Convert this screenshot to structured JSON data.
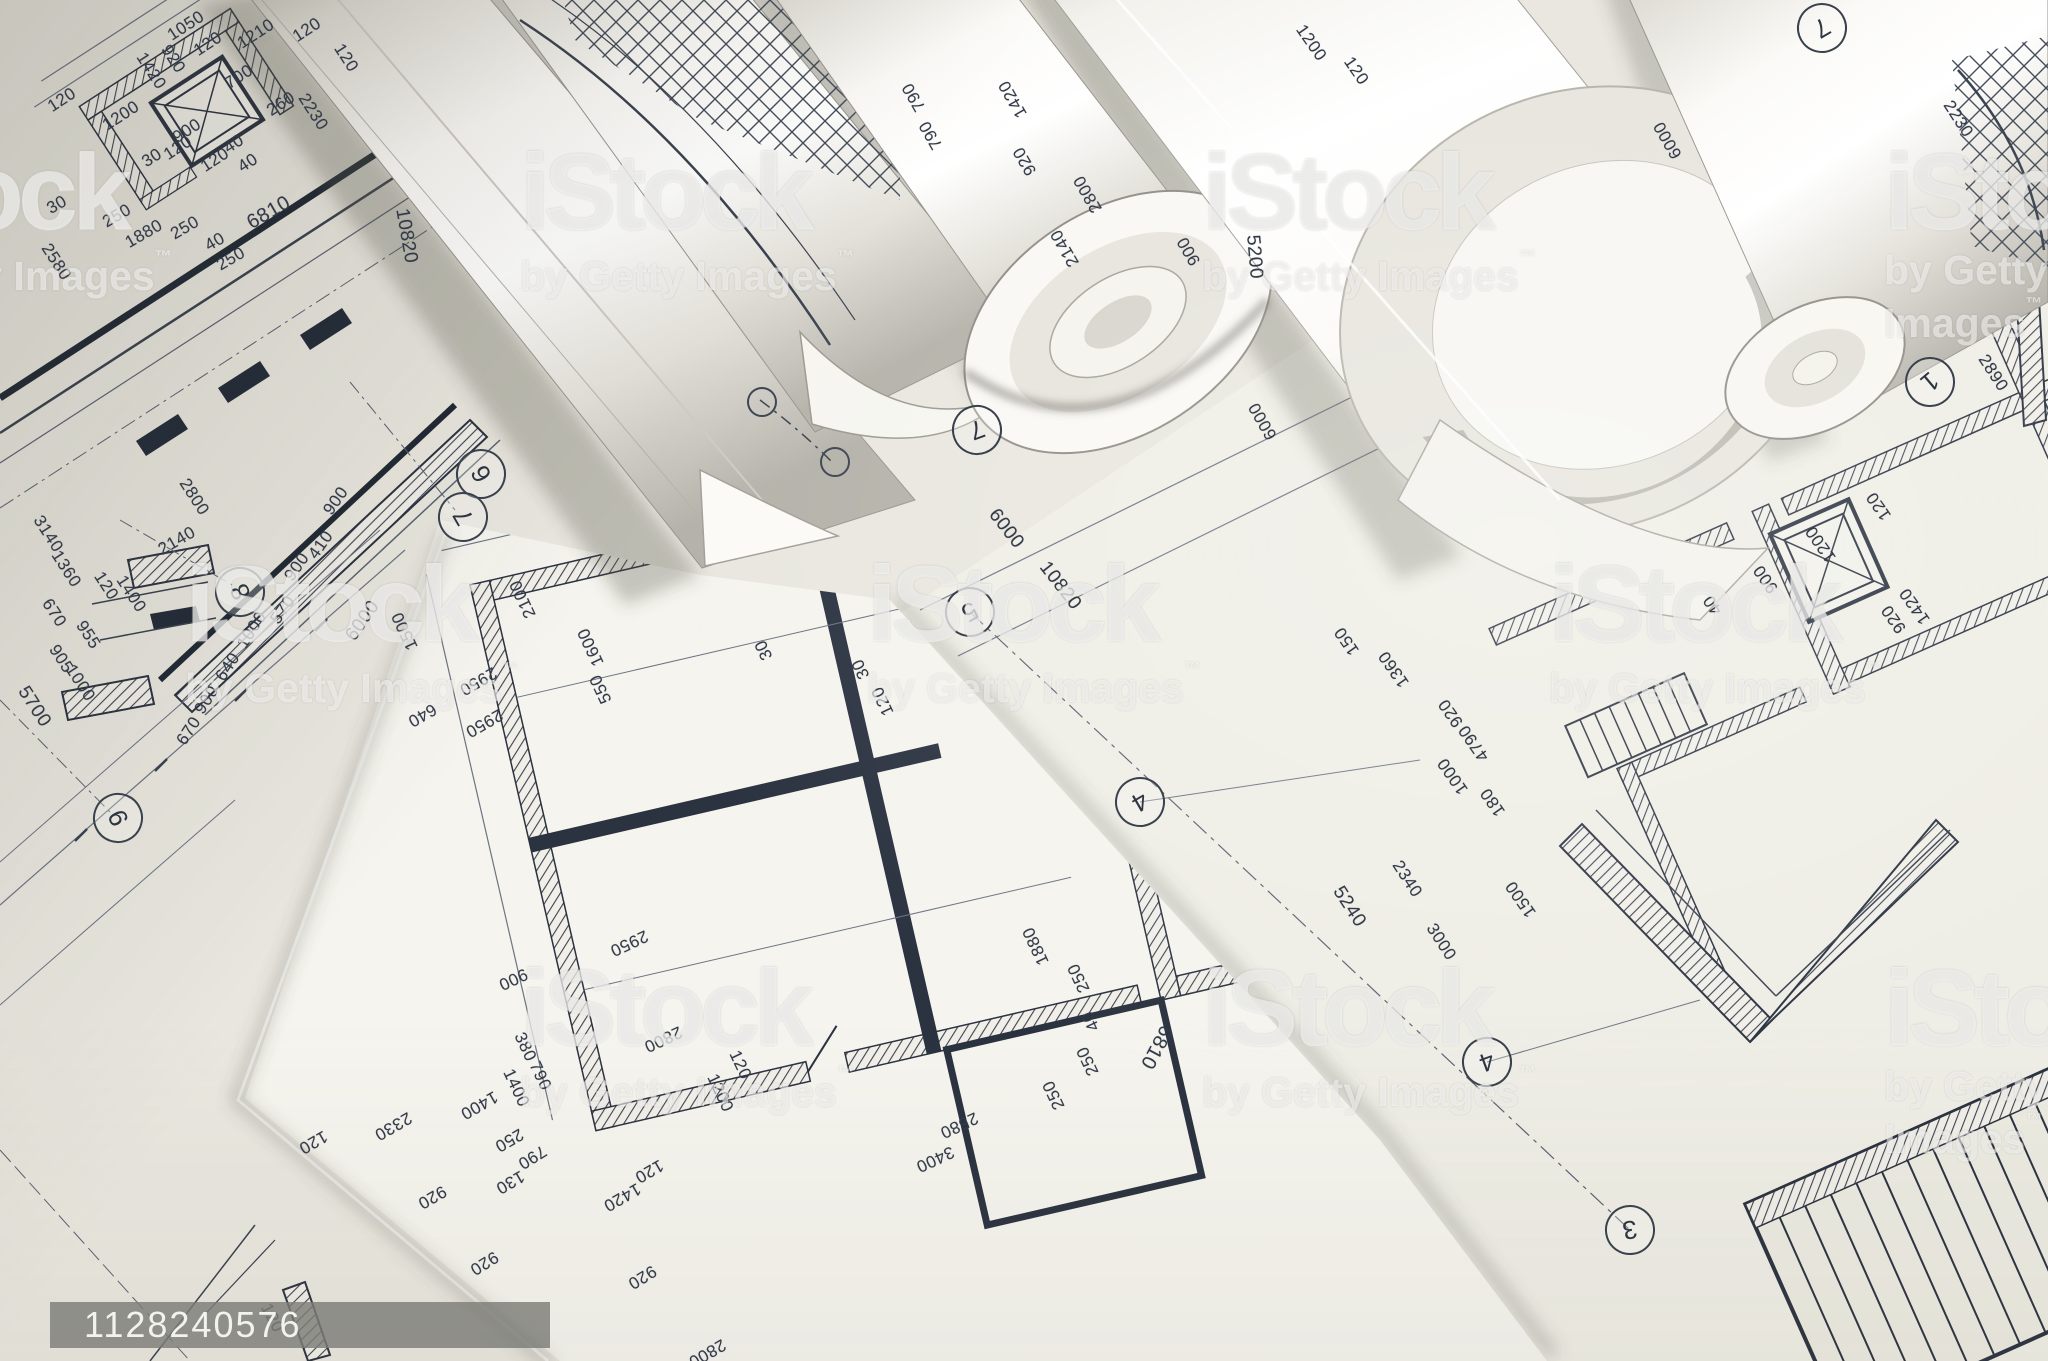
{
  "photo": {
    "subject": "rolled architectural blueprint plans",
    "palette": {
      "paper_bright": "#f5f4ee",
      "paper_mid": "#eceae2",
      "paper_dim": "#e3e1d8",
      "line_dark": "#2b3240",
      "line_mid": "#5a6272",
      "shadow": "#6b695f"
    }
  },
  "watermark": {
    "brand": "iStock",
    "byline": "by Getty Images",
    "tm": "™",
    "color": "#ffffff",
    "positions": [
      {
        "x": -162,
        "y": 148
      },
      {
        "x": 520,
        "y": 148
      },
      {
        "x": 1202,
        "y": 148
      },
      {
        "x": 1884,
        "y": 148
      },
      {
        "x": 185,
        "y": 560
      },
      {
        "x": 867,
        "y": 560
      },
      {
        "x": 1549,
        "y": 560
      },
      {
        "x": 520,
        "y": 964
      },
      {
        "x": 1202,
        "y": 964
      },
      {
        "x": 1884,
        "y": 964
      }
    ]
  },
  "id_badge": {
    "text": "1128240576",
    "bg": "#7d7d77",
    "fg": "#f2f2ee"
  },
  "labels_format": "[text, x, y, rotation_deg, optional_font_px]",
  "labels": [
    [
      "1050",
      186,
      26,
      -33
    ],
    [
      "1210",
      256,
      34,
      -33
    ],
    [
      "120",
      307,
      30,
      -33
    ],
    [
      "120",
      208,
      44,
      -33
    ],
    [
      "700",
      239,
      77,
      -33
    ],
    [
      "260",
      281,
      104,
      -33
    ],
    [
      "1200",
      121,
      116,
      -33
    ],
    [
      "120",
      62,
      100,
      -33
    ],
    [
      "1420",
      151,
      71,
      57
    ],
    [
      "920",
      173,
      59,
      57
    ],
    [
      "2230",
      313,
      112,
      57
    ],
    [
      "120",
      346,
      58,
      57
    ],
    [
      "900",
      187,
      131,
      -33
    ],
    [
      "120",
      178,
      148,
      -33
    ],
    [
      "30",
      152,
      158,
      -33
    ],
    [
      "120",
      215,
      160,
      -33
    ],
    [
      "40",
      234,
      144,
      -33
    ],
    [
      "40",
      248,
      163,
      -33
    ],
    [
      "30",
      57,
      205,
      -30
    ],
    [
      "250",
      117,
      216,
      -30
    ],
    [
      "1880",
      144,
      234,
      -30
    ],
    [
      "250",
      185,
      228,
      -30
    ],
    [
      "40",
      215,
      242,
      -30
    ],
    [
      "250",
      231,
      259,
      -30
    ],
    [
      "6810",
      269,
      213,
      -30,
      20
    ],
    [
      "10820",
      406,
      236,
      80,
      19
    ],
    [
      "2580",
      56,
      262,
      57
    ],
    [
      "2800",
      194,
      497,
      57
    ],
    [
      "2140",
      177,
      541,
      -30
    ],
    [
      "900",
      336,
      501,
      -55
    ],
    [
      "410",
      321,
      545,
      -55
    ],
    [
      "900",
      297,
      567,
      -55
    ],
    [
      "120",
      106,
      586,
      57
    ],
    [
      "1400",
      131,
      594,
      57
    ],
    [
      "570",
      283,
      610,
      -55
    ],
    [
      "1000",
      252,
      630,
      -57
    ],
    [
      "640",
      228,
      667,
      -57
    ],
    [
      "900",
      207,
      700,
      -57
    ],
    [
      "670",
      189,
      731,
      -57
    ],
    [
      "6000",
      363,
      621,
      -55,
      19
    ],
    [
      "3140",
      48,
      534,
      57
    ],
    [
      "1360",
      66,
      569,
      57
    ],
    [
      "670",
      54,
      613,
      57
    ],
    [
      "955",
      88,
      635,
      57
    ],
    [
      "905",
      61,
      659,
      57
    ],
    [
      "1000",
      80,
      683,
      57
    ],
    [
      "5700",
      34,
      707,
      57,
      19
    ],
    [
      "2100",
      523,
      599,
      245
    ],
    [
      "1500",
      405,
      631,
      245
    ],
    [
      "1600",
      591,
      647,
      245
    ],
    [
      "550",
      601,
      689,
      245
    ],
    [
      "2950",
      478,
      681,
      150
    ],
    [
      "640",
      422,
      715,
      150
    ],
    [
      "2950",
      484,
      723,
      150
    ],
    [
      "30",
      764,
      650,
      245
    ],
    [
      "30",
      861,
      669,
      245
    ],
    [
      "120",
      883,
      701,
      245
    ],
    [
      "2950",
      629,
      943,
      155
    ],
    [
      "900",
      513,
      979,
      155
    ],
    [
      "2800",
      663,
      1039,
      155
    ],
    [
      "380",
      525,
      1047,
      65
    ],
    [
      "790",
      540,
      1076,
      65
    ],
    [
      "1400",
      516,
      1088,
      65
    ],
    [
      "120",
      740,
      1065,
      65
    ],
    [
      "1200",
      720,
      1093,
      65
    ],
    [
      "2330",
      393,
      1126,
      150
    ],
    [
      "120",
      313,
      1142,
      150
    ],
    [
      "1400",
      479,
      1105,
      150
    ],
    [
      "250",
      509,
      1140,
      150
    ],
    [
      "790",
      532,
      1157,
      148
    ],
    [
      "130",
      510,
      1182,
      150
    ],
    [
      "920",
      432,
      1197,
      150
    ],
    [
      "920",
      484,
      1263,
      148
    ],
    [
      "120",
      272,
      1318,
      62
    ],
    [
      "1420",
      622,
      1197,
      150
    ],
    [
      "120",
      649,
      1171,
      150
    ],
    [
      "920",
      642,
      1277,
      148
    ],
    [
      "2800",
      707,
      1353,
      150
    ],
    [
      "1880",
      1036,
      946,
      245
    ],
    [
      "250",
      1079,
      978,
      245
    ],
    [
      "40",
      1091,
      1021,
      245
    ],
    [
      "250",
      1088,
      1061,
      245
    ],
    [
      "250",
      1054,
      1095,
      245
    ],
    [
      "6810",
      1156,
      1047,
      118,
      20
    ],
    [
      "2580",
      959,
      1125,
      155
    ],
    [
      "3400",
      935,
      1159,
      155
    ],
    [
      "6000",
      1006,
      529,
      52,
      19
    ],
    [
      "10820",
      1060,
      586,
      52,
      19
    ],
    [
      "120",
      1879,
      506,
      235
    ],
    [
      "1200",
      1821,
      544,
      235
    ],
    [
      "900",
      1766,
      579,
      235
    ],
    [
      "40",
      1713,
      605,
      235
    ],
    [
      "920",
      1894,
      619,
      235
    ],
    [
      "1420",
      1915,
      606,
      235
    ],
    [
      "2230",
      1958,
      119,
      57
    ],
    [
      "2890",
      1993,
      373,
      57
    ],
    [
      "1360",
      1394,
      669,
      235
    ],
    [
      "150",
      1347,
      641,
      235
    ],
    [
      "920",
      1451,
      713,
      235
    ],
    [
      "4790",
      1474,
      743,
      235
    ],
    [
      "1000",
      1453,
      776,
      235
    ],
    [
      "180",
      1493,
      802,
      235
    ],
    [
      "2340",
      1407,
      879,
      57
    ],
    [
      "5240",
      1349,
      907,
      57,
      19
    ],
    [
      "3000",
      1441,
      942,
      57
    ],
    [
      "1500",
      1521,
      899,
      235
    ],
    [
      "790",
      914,
      97,
      240
    ],
    [
      "790",
      931,
      135,
      240
    ],
    [
      "1420",
      1013,
      99,
      240
    ],
    [
      "920",
      1025,
      161,
      240
    ],
    [
      "2800",
      1088,
      194,
      240
    ],
    [
      "2140",
      1065,
      248,
      240
    ],
    [
      "900",
      1189,
      251,
      240
    ],
    [
      "1200",
      1311,
      43,
      55
    ],
    [
      "120",
      1356,
      71,
      55
    ],
    [
      "5200",
      1254,
      257,
      85,
      19
    ],
    [
      "6000",
      1263,
      421,
      240
    ],
    [
      "6000",
      1668,
      140,
      240
    ]
  ],
  "bubbles_format": "[digit, x, y, rotation_deg]",
  "bubbles": [
    [
      "6",
      481,
      474,
      -120
    ],
    [
      "7",
      463,
      517,
      -120
    ],
    [
      "8",
      240,
      592,
      -115
    ],
    [
      "9",
      118,
      818,
      -115
    ],
    [
      "5",
      970,
      612,
      150
    ],
    [
      "4",
      1140,
      802,
      150
    ],
    [
      "4",
      1487,
      1062,
      160
    ],
    [
      "3",
      1630,
      1230,
      170
    ],
    [
      "1",
      1930,
      382,
      140
    ],
    [
      "7",
      1822,
      28,
      150
    ],
    [
      "7",
      977,
      430,
      160
    ]
  ]
}
